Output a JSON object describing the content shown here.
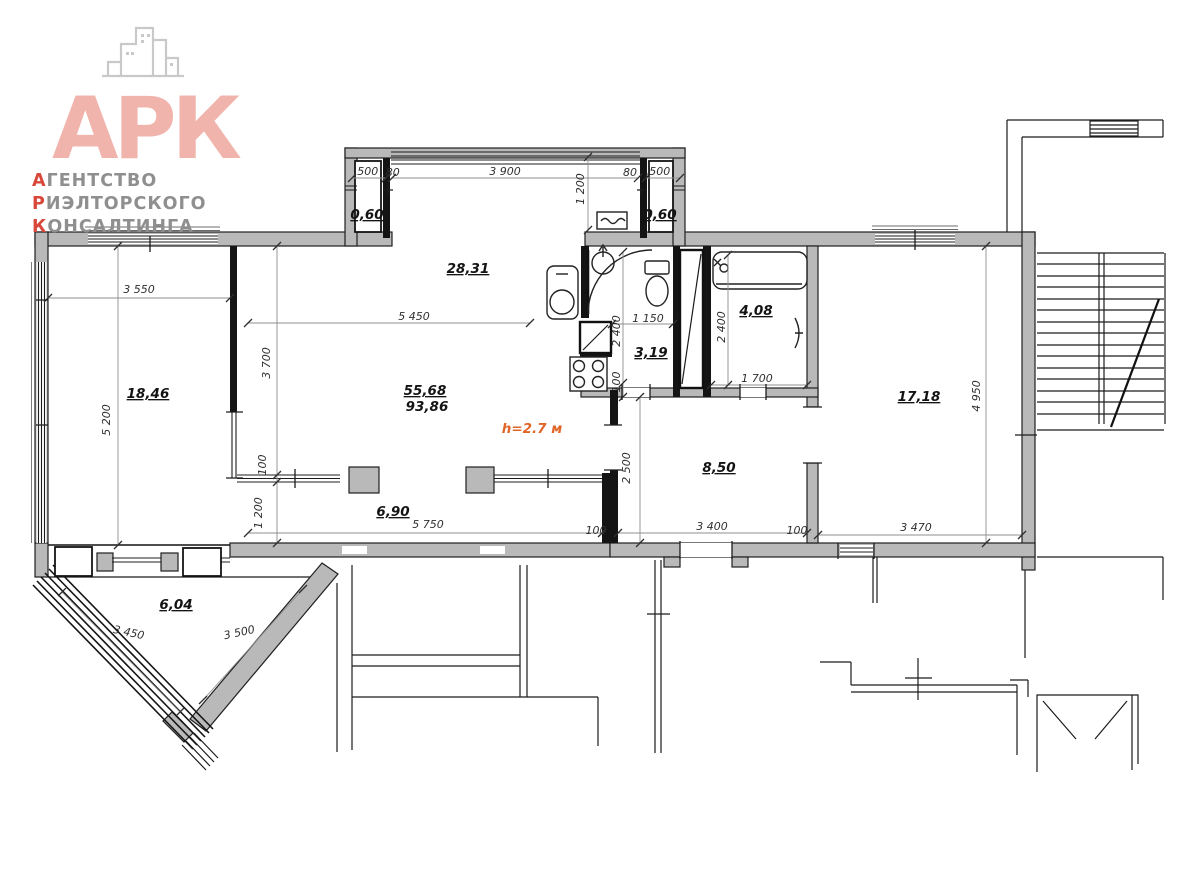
{
  "logo": {
    "monogram": "АРК",
    "lines": [
      {
        "accent": "А",
        "rest": "ГЕНТСТВО"
      },
      {
        "accent": "Р",
        "rest": "ИЭЛТОРСКОГО"
      },
      {
        "accent": "К",
        "rest": "ОНСАЛТИНГА"
      }
    ],
    "colors": {
      "accent_red": "#d9473b",
      "logo_pink": "#f0b4ac"
    }
  },
  "plan": {
    "ceiling_height": "h=2.7 м",
    "colors": {
      "wall_gray": "#b9b9b9",
      "height_orange": "#e0662a"
    },
    "areas": {
      "bay_left": "0,60",
      "bay_right": "0,60",
      "living_kitchen": "28,31",
      "room_left": "18,46",
      "living_total": "55,68",
      "total": "93,86",
      "bathroom_shower": "3,19",
      "bathroom_tub": "4,08",
      "hallway": "8,50",
      "room_right": "17,18",
      "loggia": "6,90",
      "terrace": "6,04"
    },
    "dims": {
      "bay_left_width": ".500",
      "bay_left_pier": ".80",
      "bay_window": "3 900",
      "bay_depth": "1 200",
      "bay_right_pier": "80",
      "bay_right_width": ",500",
      "room_left_width": "3 550",
      "room_left_depth": "5 200",
      "living_width": "5 450",
      "living_depth": "3 700",
      "partition_thickness": "100",
      "loggia_depth": "1 200",
      "loggia_length": "5 750",
      "loggia_wall": "100",
      "hallway_depth": "2 500",
      "hallway_width": "3 400",
      "hallway_wall": "100",
      "shower_width": "1 150",
      "shower_depth": "2 400",
      "shower_wall": "100",
      "tub_depth": "2 400",
      "tub_width": "1 700",
      "room_right_depth": "4 950",
      "room_right_width": "3 470",
      "terrace_side_left": "3 450",
      "terrace_side_right": "3 500"
    }
  }
}
